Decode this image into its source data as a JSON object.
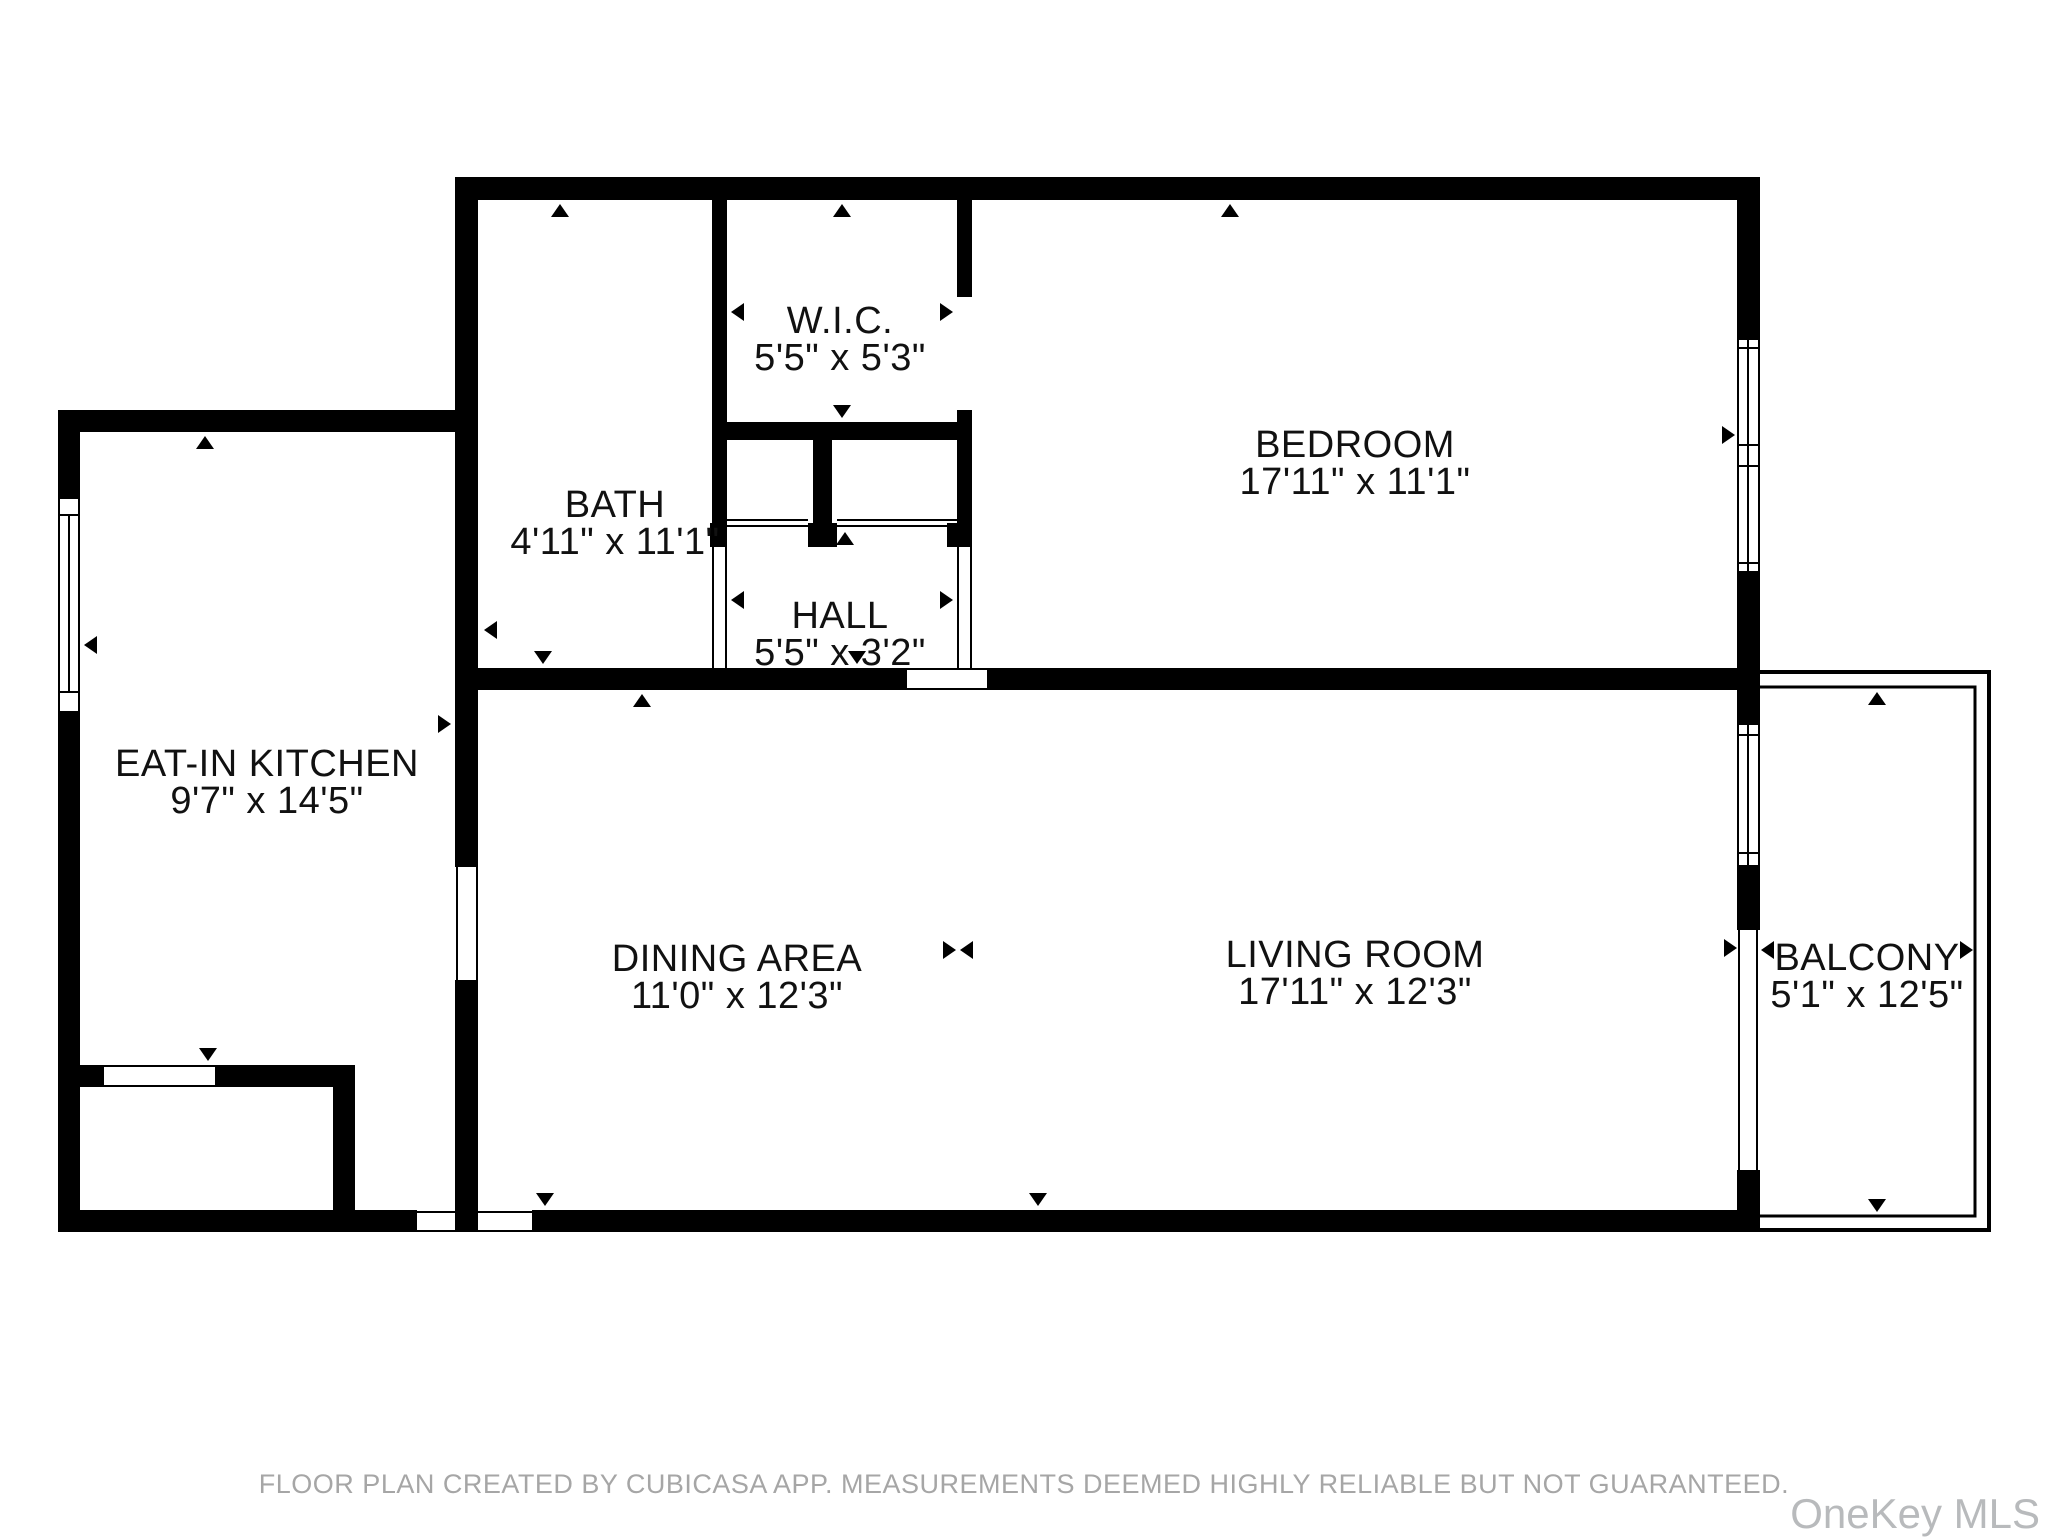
{
  "colors": {
    "wall": "#000000",
    "label_text": "#111111",
    "footer_text": "#a6a6a6",
    "watermark_text": "#b8babc",
    "background": "#ffffff"
  },
  "rooms": [
    {
      "id": "wic",
      "name": "W.I.C.",
      "dimensions": "5'5\" x 5'3\""
    },
    {
      "id": "bath",
      "name": "BATH",
      "dimensions": "4'11\" x 11'1\""
    },
    {
      "id": "hall",
      "name": "HALL",
      "dimensions": "5'5\" x 3'2\""
    },
    {
      "id": "bedroom",
      "name": "BEDROOM",
      "dimensions": "17'11\" x 11'1\""
    },
    {
      "id": "eat-in-kitchen",
      "name": "EAT-IN KITCHEN",
      "dimensions": "9'7\" x 14'5\""
    },
    {
      "id": "dining-area",
      "name": "DINING AREA",
      "dimensions": "11'0\" x 12'3\""
    },
    {
      "id": "living-room",
      "name": "LIVING ROOM",
      "dimensions": "17'11\" x 12'3\""
    },
    {
      "id": "balcony",
      "name": "BALCONY",
      "dimensions": "5'1\" x 12'5\""
    }
  ],
  "footer": {
    "disclaimer": "FLOOR PLAN CREATED BY CUBICASA APP. MEASUREMENTS DEEMED HIGHLY RELIABLE BUT NOT GUARANTEED."
  },
  "watermark": {
    "text": "OneKey MLS"
  }
}
